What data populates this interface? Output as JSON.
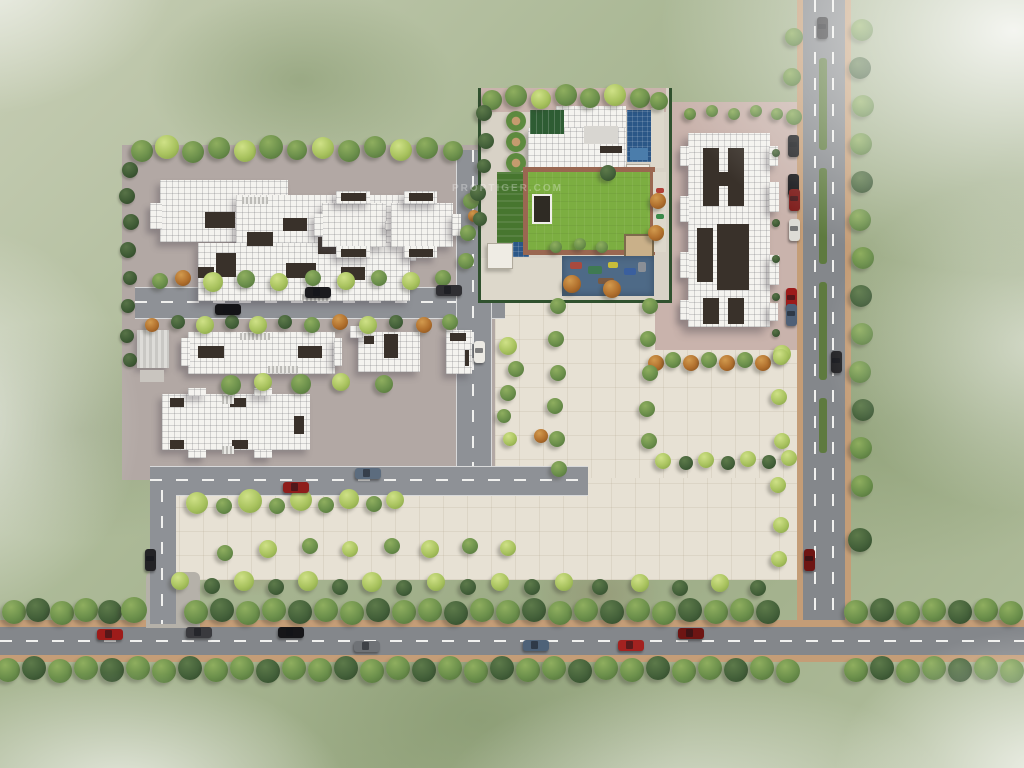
{
  "watermark": {
    "text": "PROPTIGER.COM"
  },
  "palette": {
    "pavingLeft": "#b2a8a4",
    "pavingRight": "#c9b3ac",
    "plaza": "#e7e1d4",
    "road": "#84878b",
    "roadInternal": "#8e9196",
    "curb": "#c49d77",
    "marking": "#f0f0ee",
    "roof": "#f4f3ef",
    "cut": "#39312a",
    "lawn": "#7cae41",
    "lawnDark": "#47762f",
    "pool": "#2b5787",
    "playground": "#4e6a87",
    "brick": "#9a6751",
    "hedge": "#30512e",
    "median": "#5e7a3f",
    "treeGreen": "#6b8f4b",
    "treeGreenHi": "#8fae5f",
    "treeGreenLo": "#4e6e38",
    "treeLight": "#a8c25e",
    "treeLightHi": "#cfe187",
    "treeLightLo": "#7f9c43",
    "treeDark": "#44613a",
    "treeDarkHi": "#5d7a4a",
    "treeDarkLo": "#2f4729",
    "treeOrange": "#b06f2d",
    "treeOrangeHi": "#d29a4e",
    "treeOrangeLo": "#7e4c1c",
    "shrub": "#3f5b35",
    "shrubHi": "#587347",
    "shrubLo": "#2c4126"
  },
  "scene": {
    "medians": [
      [
        819,
        58,
        8,
        92
      ],
      [
        819,
        168,
        8,
        96
      ],
      [
        819,
        282,
        8,
        98
      ],
      [
        819,
        398,
        8,
        55
      ]
    ],
    "trees": [
      [
        142,
        151,
        11,
        "g"
      ],
      [
        167,
        147,
        12,
        "l"
      ],
      [
        193,
        152,
        11,
        "g"
      ],
      [
        219,
        148,
        11,
        "g"
      ],
      [
        245,
        151,
        11,
        "l"
      ],
      [
        271,
        147,
        12,
        "g"
      ],
      [
        297,
        150,
        10,
        "g"
      ],
      [
        323,
        148,
        11,
        "l"
      ],
      [
        349,
        151,
        11,
        "g"
      ],
      [
        375,
        147,
        11,
        "g"
      ],
      [
        401,
        150,
        11,
        "l"
      ],
      [
        427,
        148,
        11,
        "g"
      ],
      [
        453,
        151,
        10,
        "g"
      ],
      [
        130,
        170,
        8,
        "s"
      ],
      [
        127,
        196,
        8,
        "s"
      ],
      [
        131,
        222,
        8,
        "s"
      ],
      [
        128,
        250,
        8,
        "s"
      ],
      [
        130,
        278,
        7,
        "s"
      ],
      [
        128,
        306,
        7,
        "s"
      ],
      [
        127,
        336,
        7,
        "s"
      ],
      [
        130,
        360,
        7,
        "s"
      ],
      [
        160,
        281,
        8,
        "g"
      ],
      [
        183,
        278,
        8,
        "o"
      ],
      [
        213,
        282,
        10,
        "l"
      ],
      [
        246,
        279,
        9,
        "g"
      ],
      [
        279,
        282,
        9,
        "l"
      ],
      [
        313,
        278,
        8,
        "g"
      ],
      [
        346,
        281,
        9,
        "l"
      ],
      [
        379,
        278,
        8,
        "g"
      ],
      [
        411,
        281,
        9,
        "l"
      ],
      [
        443,
        278,
        8,
        "g"
      ],
      [
        152,
        325,
        7,
        "o"
      ],
      [
        178,
        322,
        7,
        "d"
      ],
      [
        205,
        325,
        9,
        "l"
      ],
      [
        232,
        322,
        7,
        "d"
      ],
      [
        258,
        325,
        9,
        "l"
      ],
      [
        285,
        322,
        7,
        "d"
      ],
      [
        312,
        325,
        8,
        "g"
      ],
      [
        340,
        322,
        8,
        "o"
      ],
      [
        368,
        325,
        9,
        "l"
      ],
      [
        396,
        322,
        7,
        "d"
      ],
      [
        424,
        325,
        8,
        "o"
      ],
      [
        450,
        322,
        8,
        "g"
      ],
      [
        231,
        385,
        10,
        "g"
      ],
      [
        263,
        382,
        9,
        "l"
      ],
      [
        301,
        384,
        10,
        "g"
      ],
      [
        341,
        382,
        9,
        "l"
      ],
      [
        384,
        384,
        9,
        "g"
      ],
      [
        471,
        201,
        8,
        "g"
      ],
      [
        474,
        216,
        6,
        "o"
      ],
      [
        468,
        233,
        8,
        "g"
      ],
      [
        466,
        261,
        8,
        "g"
      ],
      [
        508,
        346,
        9,
        "l"
      ],
      [
        516,
        369,
        8,
        "g"
      ],
      [
        508,
        393,
        8,
        "g"
      ],
      [
        504,
        416,
        7,
        "g"
      ],
      [
        510,
        439,
        7,
        "l"
      ],
      [
        492,
        100,
        10,
        "g"
      ],
      [
        516,
        96,
        11,
        "g"
      ],
      [
        541,
        99,
        10,
        "l"
      ],
      [
        566,
        95,
        11,
        "g"
      ],
      [
        590,
        98,
        10,
        "g"
      ],
      [
        615,
        95,
        11,
        "l"
      ],
      [
        640,
        98,
        10,
        "g"
      ],
      [
        659,
        101,
        9,
        "g"
      ],
      [
        484,
        113,
        8,
        "d"
      ],
      [
        486,
        141,
        8,
        "d"
      ],
      [
        484,
        166,
        7,
        "d"
      ],
      [
        478,
        193,
        8,
        "d"
      ],
      [
        480,
        219,
        7,
        "d"
      ],
      [
        556,
        247,
        6,
        "g"
      ],
      [
        580,
        244,
        6,
        "g"
      ],
      [
        602,
        247,
        6,
        "g"
      ],
      [
        608,
        173,
        8,
        "d"
      ],
      [
        658,
        201,
        8,
        "o"
      ],
      [
        656,
        233,
        8,
        "o"
      ],
      [
        572,
        284,
        9,
        "o"
      ],
      [
        612,
        289,
        9,
        "o"
      ],
      [
        690,
        114,
        6,
        "g"
      ],
      [
        712,
        111,
        6,
        "g"
      ],
      [
        734,
        114,
        6,
        "g"
      ],
      [
        756,
        111,
        6,
        "g"
      ],
      [
        777,
        114,
        6,
        "g"
      ],
      [
        776,
        153,
        4,
        "s"
      ],
      [
        776,
        223,
        4,
        "s"
      ],
      [
        776,
        259,
        4,
        "s"
      ],
      [
        776,
        297,
        4,
        "s"
      ],
      [
        776,
        333,
        4,
        "s"
      ],
      [
        656,
        363,
        8,
        "o"
      ],
      [
        673,
        360,
        8,
        "g"
      ],
      [
        691,
        363,
        8,
        "o"
      ],
      [
        709,
        360,
        8,
        "g"
      ],
      [
        727,
        363,
        8,
        "o"
      ],
      [
        745,
        360,
        8,
        "g"
      ],
      [
        763,
        363,
        8,
        "o"
      ],
      [
        782,
        354,
        9,
        "l"
      ],
      [
        663,
        461,
        8,
        "l"
      ],
      [
        686,
        463,
        7,
        "d"
      ],
      [
        706,
        460,
        8,
        "l"
      ],
      [
        728,
        463,
        7,
        "d"
      ],
      [
        748,
        459,
        8,
        "l"
      ],
      [
        769,
        462,
        7,
        "d"
      ],
      [
        789,
        458,
        8,
        "l"
      ],
      [
        197,
        503,
        11,
        "l"
      ],
      [
        224,
        506,
        8,
        "g"
      ],
      [
        250,
        501,
        12,
        "l"
      ],
      [
        277,
        506,
        8,
        "g"
      ],
      [
        301,
        500,
        11,
        "l"
      ],
      [
        326,
        505,
        8,
        "g"
      ],
      [
        349,
        499,
        10,
        "l"
      ],
      [
        374,
        504,
        8,
        "g"
      ],
      [
        395,
        500,
        9,
        "l"
      ],
      [
        225,
        553,
        8,
        "g"
      ],
      [
        268,
        549,
        9,
        "l"
      ],
      [
        310,
        546,
        8,
        "g"
      ],
      [
        350,
        549,
        8,
        "l"
      ],
      [
        392,
        546,
        8,
        "g"
      ],
      [
        430,
        549,
        9,
        "l"
      ],
      [
        470,
        546,
        8,
        "g"
      ],
      [
        508,
        548,
        8,
        "l"
      ],
      [
        558,
        306,
        8,
        "g"
      ],
      [
        556,
        339,
        8,
        "g"
      ],
      [
        558,
        373,
        8,
        "g"
      ],
      [
        555,
        406,
        8,
        "g"
      ],
      [
        557,
        439,
        8,
        "g"
      ],
      [
        559,
        469,
        8,
        "g"
      ],
      [
        541,
        436,
        7,
        "o"
      ],
      [
        650,
        306,
        8,
        "g"
      ],
      [
        648,
        339,
        8,
        "g"
      ],
      [
        650,
        373,
        8,
        "g"
      ],
      [
        647,
        409,
        8,
        "g"
      ],
      [
        649,
        441,
        8,
        "g"
      ],
      [
        180,
        581,
        9,
        "l"
      ],
      [
        212,
        586,
        8,
        "d"
      ],
      [
        244,
        581,
        10,
        "l"
      ],
      [
        276,
        587,
        8,
        "d"
      ],
      [
        308,
        581,
        10,
        "l"
      ],
      [
        340,
        587,
        8,
        "d"
      ],
      [
        372,
        582,
        10,
        "l"
      ],
      [
        404,
        588,
        8,
        "d"
      ],
      [
        436,
        582,
        9,
        "l"
      ],
      [
        468,
        587,
        8,
        "d"
      ],
      [
        500,
        582,
        9,
        "l"
      ],
      [
        532,
        587,
        8,
        "d"
      ],
      [
        564,
        582,
        9,
        "l"
      ],
      [
        600,
        587,
        8,
        "d"
      ],
      [
        640,
        583,
        9,
        "l"
      ],
      [
        680,
        588,
        8,
        "d"
      ],
      [
        720,
        583,
        9,
        "l"
      ],
      [
        758,
        588,
        8,
        "d"
      ],
      [
        14,
        612,
        12,
        "g"
      ],
      [
        38,
        610,
        12,
        "d"
      ],
      [
        62,
        613,
        12,
        "g"
      ],
      [
        86,
        610,
        12,
        "g"
      ],
      [
        110,
        612,
        12,
        "d"
      ],
      [
        134,
        610,
        13,
        "g"
      ],
      [
        196,
        612,
        12,
        "g"
      ],
      [
        222,
        610,
        12,
        "d"
      ],
      [
        248,
        613,
        12,
        "g"
      ],
      [
        274,
        610,
        12,
        "g"
      ],
      [
        300,
        612,
        12,
        "d"
      ],
      [
        326,
        610,
        12,
        "g"
      ],
      [
        352,
        613,
        12,
        "g"
      ],
      [
        378,
        610,
        12,
        "d"
      ],
      [
        404,
        612,
        12,
        "g"
      ],
      [
        430,
        610,
        12,
        "g"
      ],
      [
        456,
        613,
        12,
        "d"
      ],
      [
        482,
        610,
        12,
        "g"
      ],
      [
        508,
        612,
        12,
        "g"
      ],
      [
        534,
        610,
        12,
        "d"
      ],
      [
        560,
        613,
        12,
        "g"
      ],
      [
        586,
        610,
        12,
        "g"
      ],
      [
        612,
        612,
        12,
        "d"
      ],
      [
        638,
        610,
        12,
        "g"
      ],
      [
        664,
        613,
        12,
        "g"
      ],
      [
        690,
        610,
        12,
        "d"
      ],
      [
        716,
        612,
        12,
        "g"
      ],
      [
        742,
        610,
        12,
        "g"
      ],
      [
        768,
        612,
        12,
        "d"
      ],
      [
        856,
        612,
        12,
        "g"
      ],
      [
        882,
        610,
        12,
        "d"
      ],
      [
        908,
        613,
        12,
        "g"
      ],
      [
        934,
        610,
        12,
        "g"
      ],
      [
        960,
        612,
        12,
        "d"
      ],
      [
        986,
        610,
        12,
        "g"
      ],
      [
        1011,
        613,
        12,
        "g"
      ],
      [
        8,
        670,
        12,
        "g"
      ],
      [
        34,
        668,
        12,
        "d"
      ],
      [
        60,
        671,
        12,
        "g"
      ],
      [
        86,
        668,
        12,
        "g"
      ],
      [
        112,
        670,
        12,
        "d"
      ],
      [
        138,
        668,
        12,
        "g"
      ],
      [
        164,
        671,
        12,
        "g"
      ],
      [
        190,
        668,
        12,
        "d"
      ],
      [
        216,
        670,
        12,
        "g"
      ],
      [
        242,
        668,
        12,
        "g"
      ],
      [
        268,
        671,
        12,
        "d"
      ],
      [
        294,
        668,
        12,
        "g"
      ],
      [
        320,
        670,
        12,
        "g"
      ],
      [
        346,
        668,
        12,
        "d"
      ],
      [
        372,
        671,
        12,
        "g"
      ],
      [
        398,
        668,
        12,
        "g"
      ],
      [
        424,
        670,
        12,
        "d"
      ],
      [
        450,
        668,
        12,
        "g"
      ],
      [
        476,
        671,
        12,
        "g"
      ],
      [
        502,
        668,
        12,
        "d"
      ],
      [
        528,
        670,
        12,
        "g"
      ],
      [
        554,
        668,
        12,
        "g"
      ],
      [
        580,
        671,
        12,
        "d"
      ],
      [
        606,
        668,
        12,
        "g"
      ],
      [
        632,
        670,
        12,
        "g"
      ],
      [
        658,
        668,
        12,
        "d"
      ],
      [
        684,
        671,
        12,
        "g"
      ],
      [
        710,
        668,
        12,
        "g"
      ],
      [
        736,
        670,
        12,
        "d"
      ],
      [
        762,
        668,
        12,
        "g"
      ],
      [
        788,
        671,
        12,
        "g"
      ],
      [
        856,
        670,
        12,
        "g"
      ],
      [
        882,
        668,
        12,
        "d"
      ],
      [
        908,
        671,
        12,
        "g"
      ],
      [
        934,
        668,
        12,
        "g"
      ],
      [
        960,
        670,
        12,
        "d"
      ],
      [
        986,
        668,
        12,
        "g"
      ],
      [
        1012,
        671,
        12,
        "g"
      ],
      [
        862,
        30,
        11,
        "g"
      ],
      [
        860,
        68,
        11,
        "d"
      ],
      [
        863,
        106,
        11,
        "g"
      ],
      [
        861,
        144,
        11,
        "g"
      ],
      [
        862,
        182,
        11,
        "d"
      ],
      [
        860,
        220,
        11,
        "g"
      ],
      [
        863,
        258,
        11,
        "g"
      ],
      [
        861,
        296,
        11,
        "d"
      ],
      [
        862,
        334,
        11,
        "g"
      ],
      [
        860,
        372,
        11,
        "g"
      ],
      [
        863,
        410,
        11,
        "d"
      ],
      [
        861,
        448,
        11,
        "g"
      ],
      [
        862,
        486,
        11,
        "g"
      ],
      [
        860,
        540,
        12,
        "d"
      ],
      [
        794,
        37,
        9,
        "g"
      ],
      [
        792,
        77,
        9,
        "g"
      ],
      [
        794,
        117,
        8,
        "g"
      ],
      [
        781,
        357,
        8,
        "l"
      ],
      [
        779,
        397,
        8,
        "l"
      ],
      [
        782,
        441,
        8,
        "l"
      ],
      [
        778,
        485,
        8,
        "l"
      ],
      [
        781,
        525,
        8,
        "l"
      ],
      [
        779,
        559,
        8,
        "l"
      ]
    ],
    "cars": [
      [
        318,
        292,
        "h",
        "#1b1b1e"
      ],
      [
        449,
        290,
        "h",
        "#2f2f33"
      ],
      [
        228,
        309,
        "h",
        "#141417"
      ],
      [
        296,
        487,
        "h",
        "#8e1e1c"
      ],
      [
        368,
        473,
        "h",
        "#5c6c7e"
      ],
      [
        150,
        560,
        "v",
        "#232326"
      ],
      [
        479,
        352,
        "v",
        "#eceae4"
      ],
      [
        793,
        146,
        "v",
        "#1c1c1f"
      ],
      [
        793,
        185,
        "v",
        "#131315"
      ],
      [
        794,
        200,
        "v",
        "#7c1a18"
      ],
      [
        794,
        230,
        "v",
        "#dddcd6"
      ],
      [
        791,
        299,
        "v",
        "#9c1b1a"
      ],
      [
        791,
        315,
        "v",
        "#4f6077"
      ],
      [
        822,
        28,
        "v",
        "#2e2e31"
      ],
      [
        836,
        362,
        "v",
        "#232326"
      ],
      [
        809,
        560,
        "v",
        "#6e1513"
      ],
      [
        110,
        634,
        "h",
        "#9e1c1a"
      ],
      [
        199,
        632,
        "h",
        "#3a3a3e"
      ],
      [
        291,
        632,
        "h",
        "#161619"
      ],
      [
        367,
        646,
        "h",
        "#6f7276"
      ],
      [
        536,
        645,
        "h",
        "#4e6278"
      ],
      [
        631,
        645,
        "h",
        "#a32220"
      ],
      [
        691,
        633,
        "h",
        "#6e1513"
      ]
    ]
  }
}
